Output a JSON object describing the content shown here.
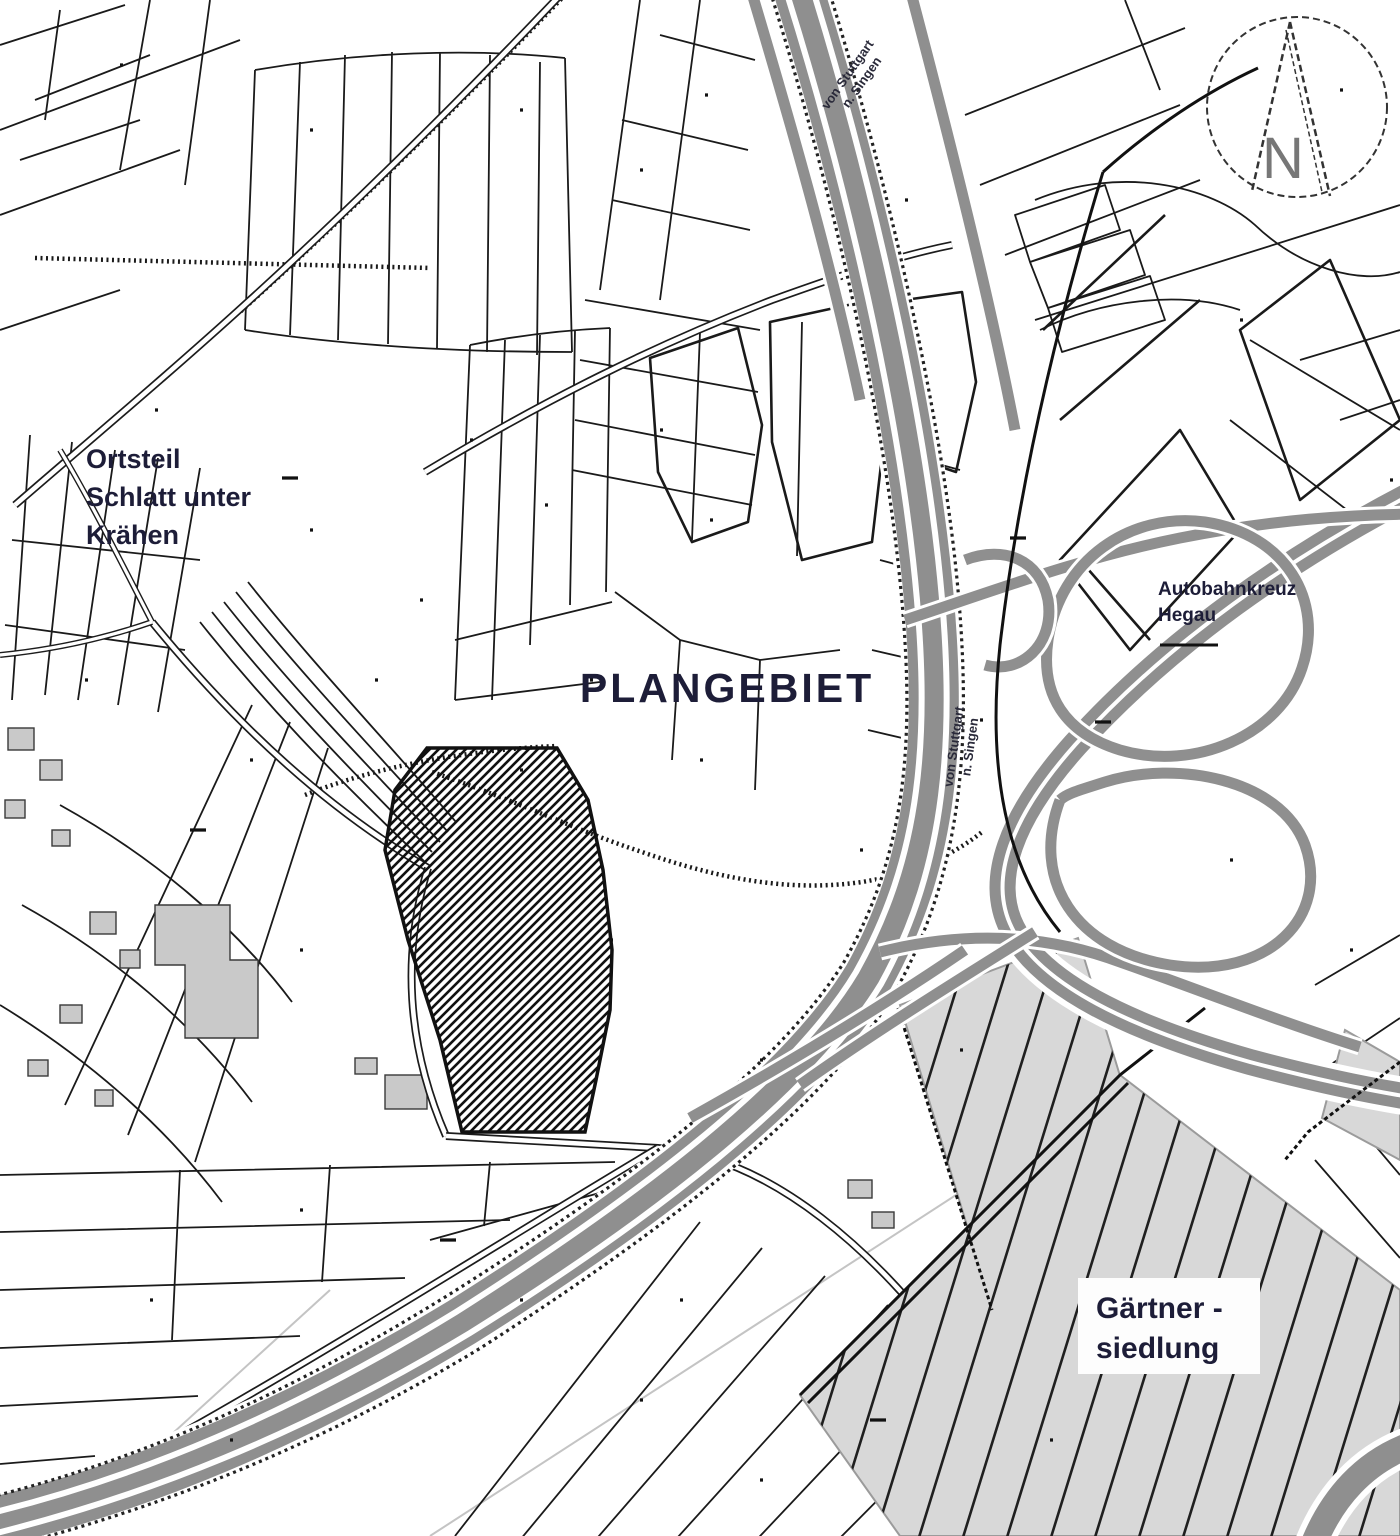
{
  "map": {
    "labels": {
      "plangebiet": "PLANGEBIET",
      "ortsteil_lines": [
        "Ortsteil",
        "Schlatt unter",
        "Krähen"
      ],
      "autobahnkreuz_lines": [
        "Autobahnkreuz",
        "Hegau"
      ],
      "gaertnersiedlung_lines": [
        "Gärtner -",
        "siedlung"
      ],
      "highway_top_lines": [
        "von Stuttgart",
        "n. Singen"
      ],
      "highway_mid_lines": [
        "von Stuttgart",
        "n. Singen"
      ],
      "compass_letter": "N"
    },
    "colors": {
      "paper": "#ffffff",
      "line_black": "#1a1a1a",
      "motorway_gray": "#8f8f8f",
      "building_gray": "#c9c9c9",
      "area_gray": "#d8d8d8",
      "label_navy": "#1d1d38",
      "compass_gray": "#777777",
      "faint_gray": "#c4c4c4"
    }
  }
}
